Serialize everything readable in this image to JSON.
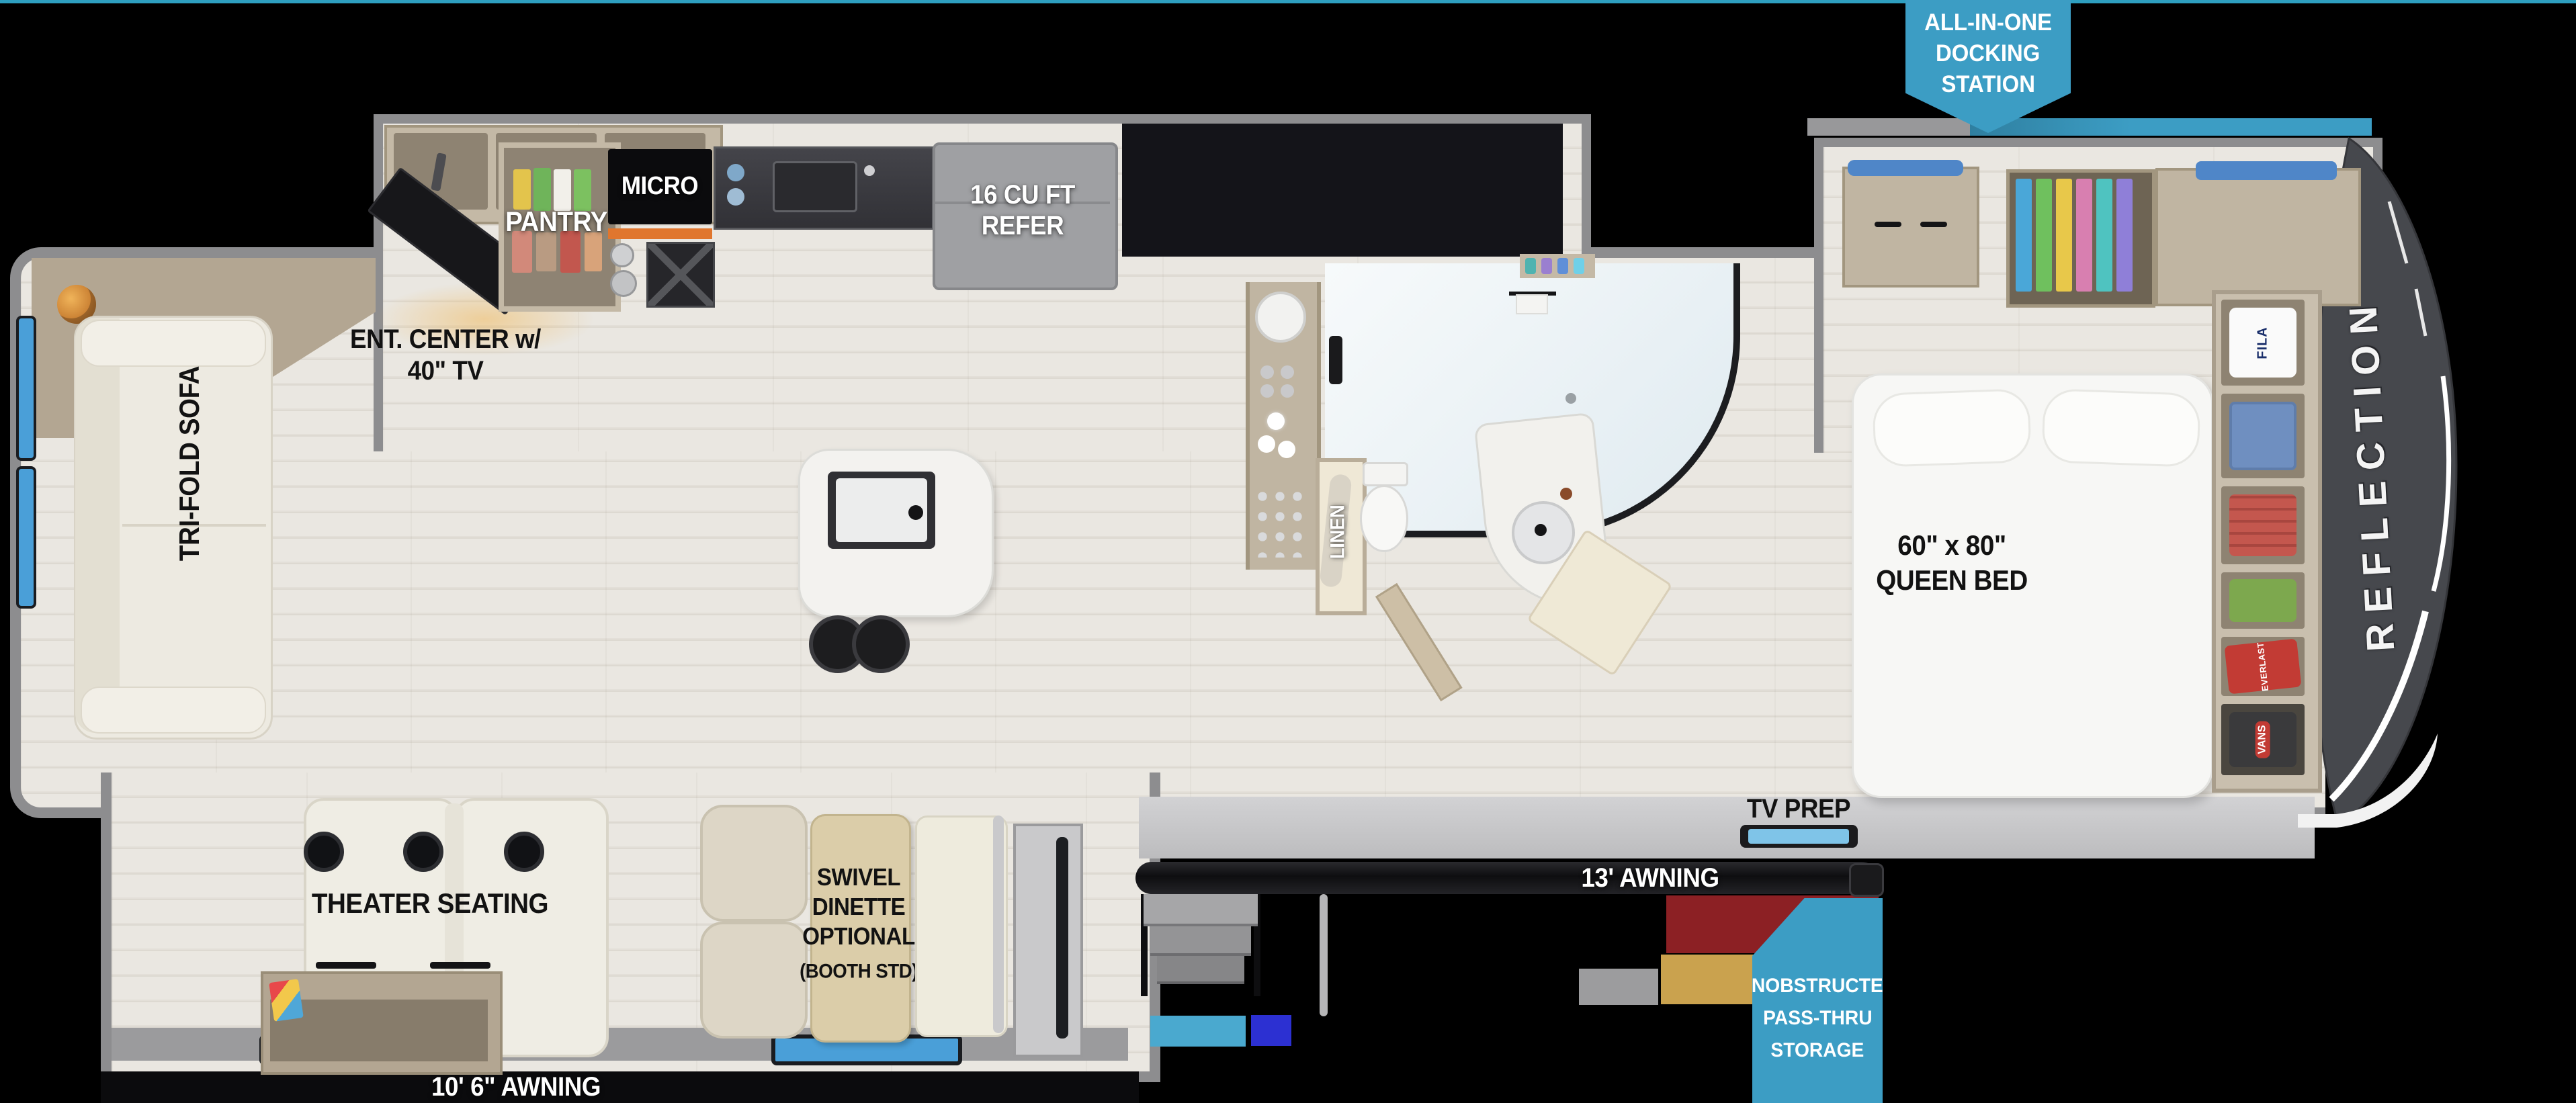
{
  "brand": {
    "name_vertical": "REFLECTION"
  },
  "callouts": {
    "docking_station": {
      "line1": "ALL-IN-ONE",
      "line2": "DOCKING",
      "line3": "STATION",
      "color": "#3c9dc4"
    },
    "pass_thru_storage": {
      "line1": "UNOBSTRUCTED",
      "line2": "PASS-THRU",
      "line3": "STORAGE",
      "color": "#3c9dc4"
    }
  },
  "labels": {
    "ent_center_line1": "ENT. CENTER w/",
    "ent_center_line2": "40\" TV",
    "pantry": "PANTRY",
    "micro": "MICRO",
    "refer_line1": "16 CU FT",
    "refer_line2": "REFER",
    "tri_fold_sofa": "TRI-FOLD SOFA",
    "linen": "LINEN",
    "queen_bed_line1": "60\" x 80\"",
    "queen_bed_line2": "QUEEN BED",
    "tv_prep": "TV PREP",
    "awning_main": "13' AWNING",
    "awning_slide": "10' 6\" AWNING",
    "theater_seating": "THEATER SEATING",
    "dinette_line1": "SWIVEL",
    "dinette_line2": "DINETTE",
    "dinette_line3": "OPTIONAL",
    "dinette_line4": "(BOOTH STD)",
    "wardrobe_fila": "FILA",
    "wardrobe_everlast": "EVERLAST",
    "wardrobe_vans": "VANS"
  },
  "colors": {
    "accent_blue": "#3c9dc4",
    "teal_line": "#2e9fc0",
    "wall_gray": "#8d8d8f",
    "cap_gray": "#46484d",
    "cabinet_tan": "#b9ad99",
    "floor_light": "#e9e6e0",
    "storage_red": "#8c2024",
    "storage_gold": "#caa24e",
    "storage_light_blue": "#4aa9cf",
    "storage_dark_blue": "#2c30d2",
    "window_blue": "#4a9fd8"
  }
}
